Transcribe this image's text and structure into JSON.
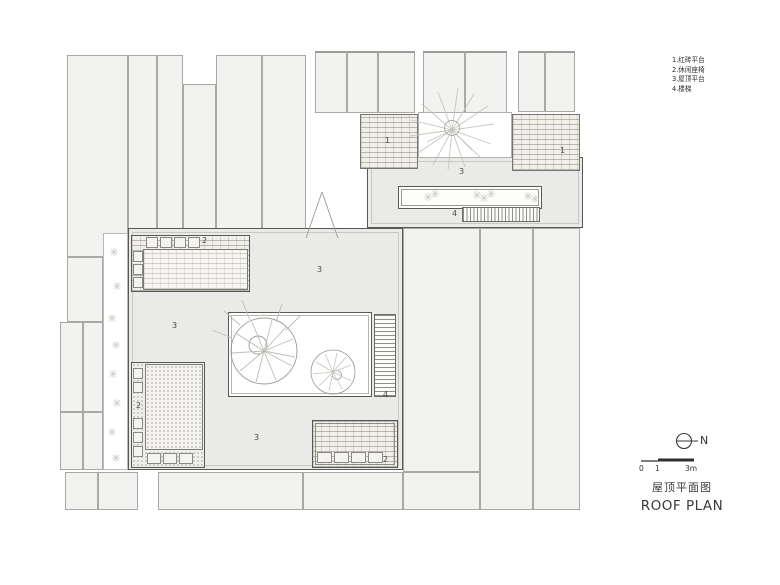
{
  "legend": {
    "items": [
      "1.红砖平台",
      "2.休闲座椅",
      "3.屋顶平台",
      "4.楼梯"
    ]
  },
  "plan": {
    "labels": [
      {
        "text": "1"
      },
      {
        "text": "1"
      },
      {
        "text": "2"
      },
      {
        "text": "2"
      },
      {
        "text": "2"
      },
      {
        "text": "3"
      },
      {
        "text": "3"
      },
      {
        "text": "3"
      },
      {
        "text": "3"
      },
      {
        "text": "4"
      },
      {
        "text": "4"
      }
    ]
  },
  "annotations": {
    "north_label": "N",
    "scale": {
      "zero": "0",
      "one": "1",
      "three": "3m"
    },
    "title_zh": "屋顶平面图",
    "title_en": "ROOF PLAN"
  },
  "colors": {
    "context_fill": "#f2f2f0",
    "roof_fill": "#eaeae8",
    "outline": "#585855",
    "line_light": "#c9c8c3"
  }
}
